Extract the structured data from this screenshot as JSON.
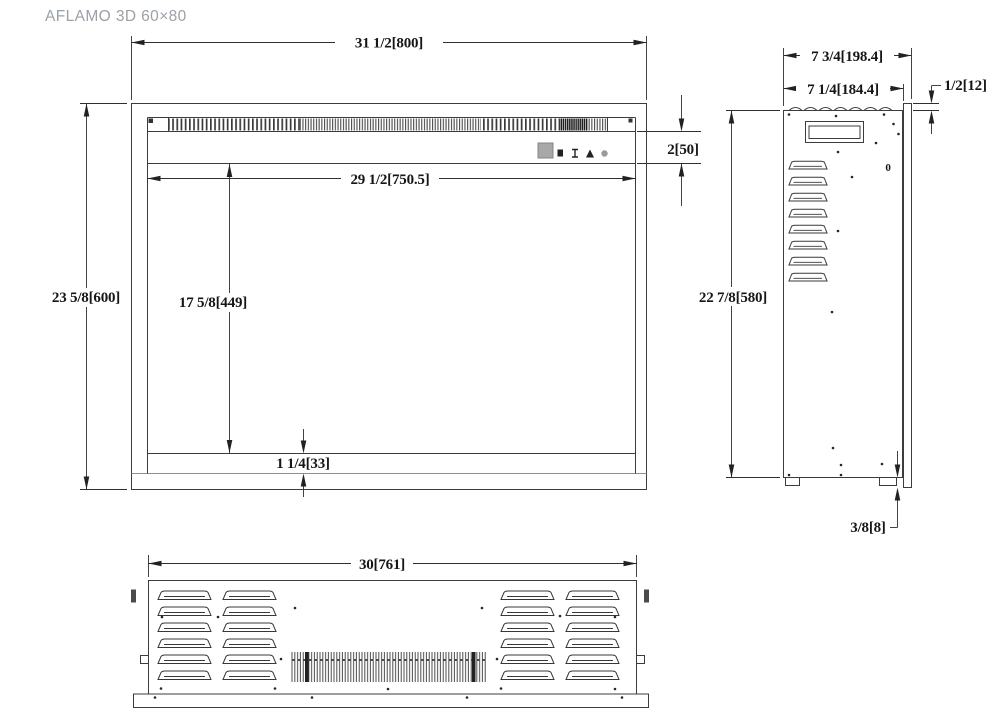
{
  "title": "AFLAMO 3D 60×80",
  "front_view": {
    "dims": {
      "overall_width": "31 1/2[800]",
      "overall_height": "23 5/8[600]",
      "opening_width": "29 1/2[750.5]",
      "opening_height": "17 5/8[449]",
      "control_band_height": "2[50]",
      "bottom_lip": "1 1/4[33]"
    }
  },
  "side_view": {
    "dims": {
      "overall_depth": "7 3/4[198.4]",
      "body_depth": "7 1/4[184.4]",
      "front_flange_depth": "1/2[12]",
      "overall_height": "22 7/8[580]",
      "bottom_flange": "3/8[8]"
    },
    "marks": {
      "zero": "0"
    }
  },
  "bottom_view": {
    "dims": {
      "overall_width": "30[761]"
    }
  },
  "colors": {
    "line": "#3c3c3c",
    "light_line": "#8f8f8f",
    "text": "#161616",
    "title": "#9aa1a7",
    "control_fill": "#a8a8a8"
  }
}
